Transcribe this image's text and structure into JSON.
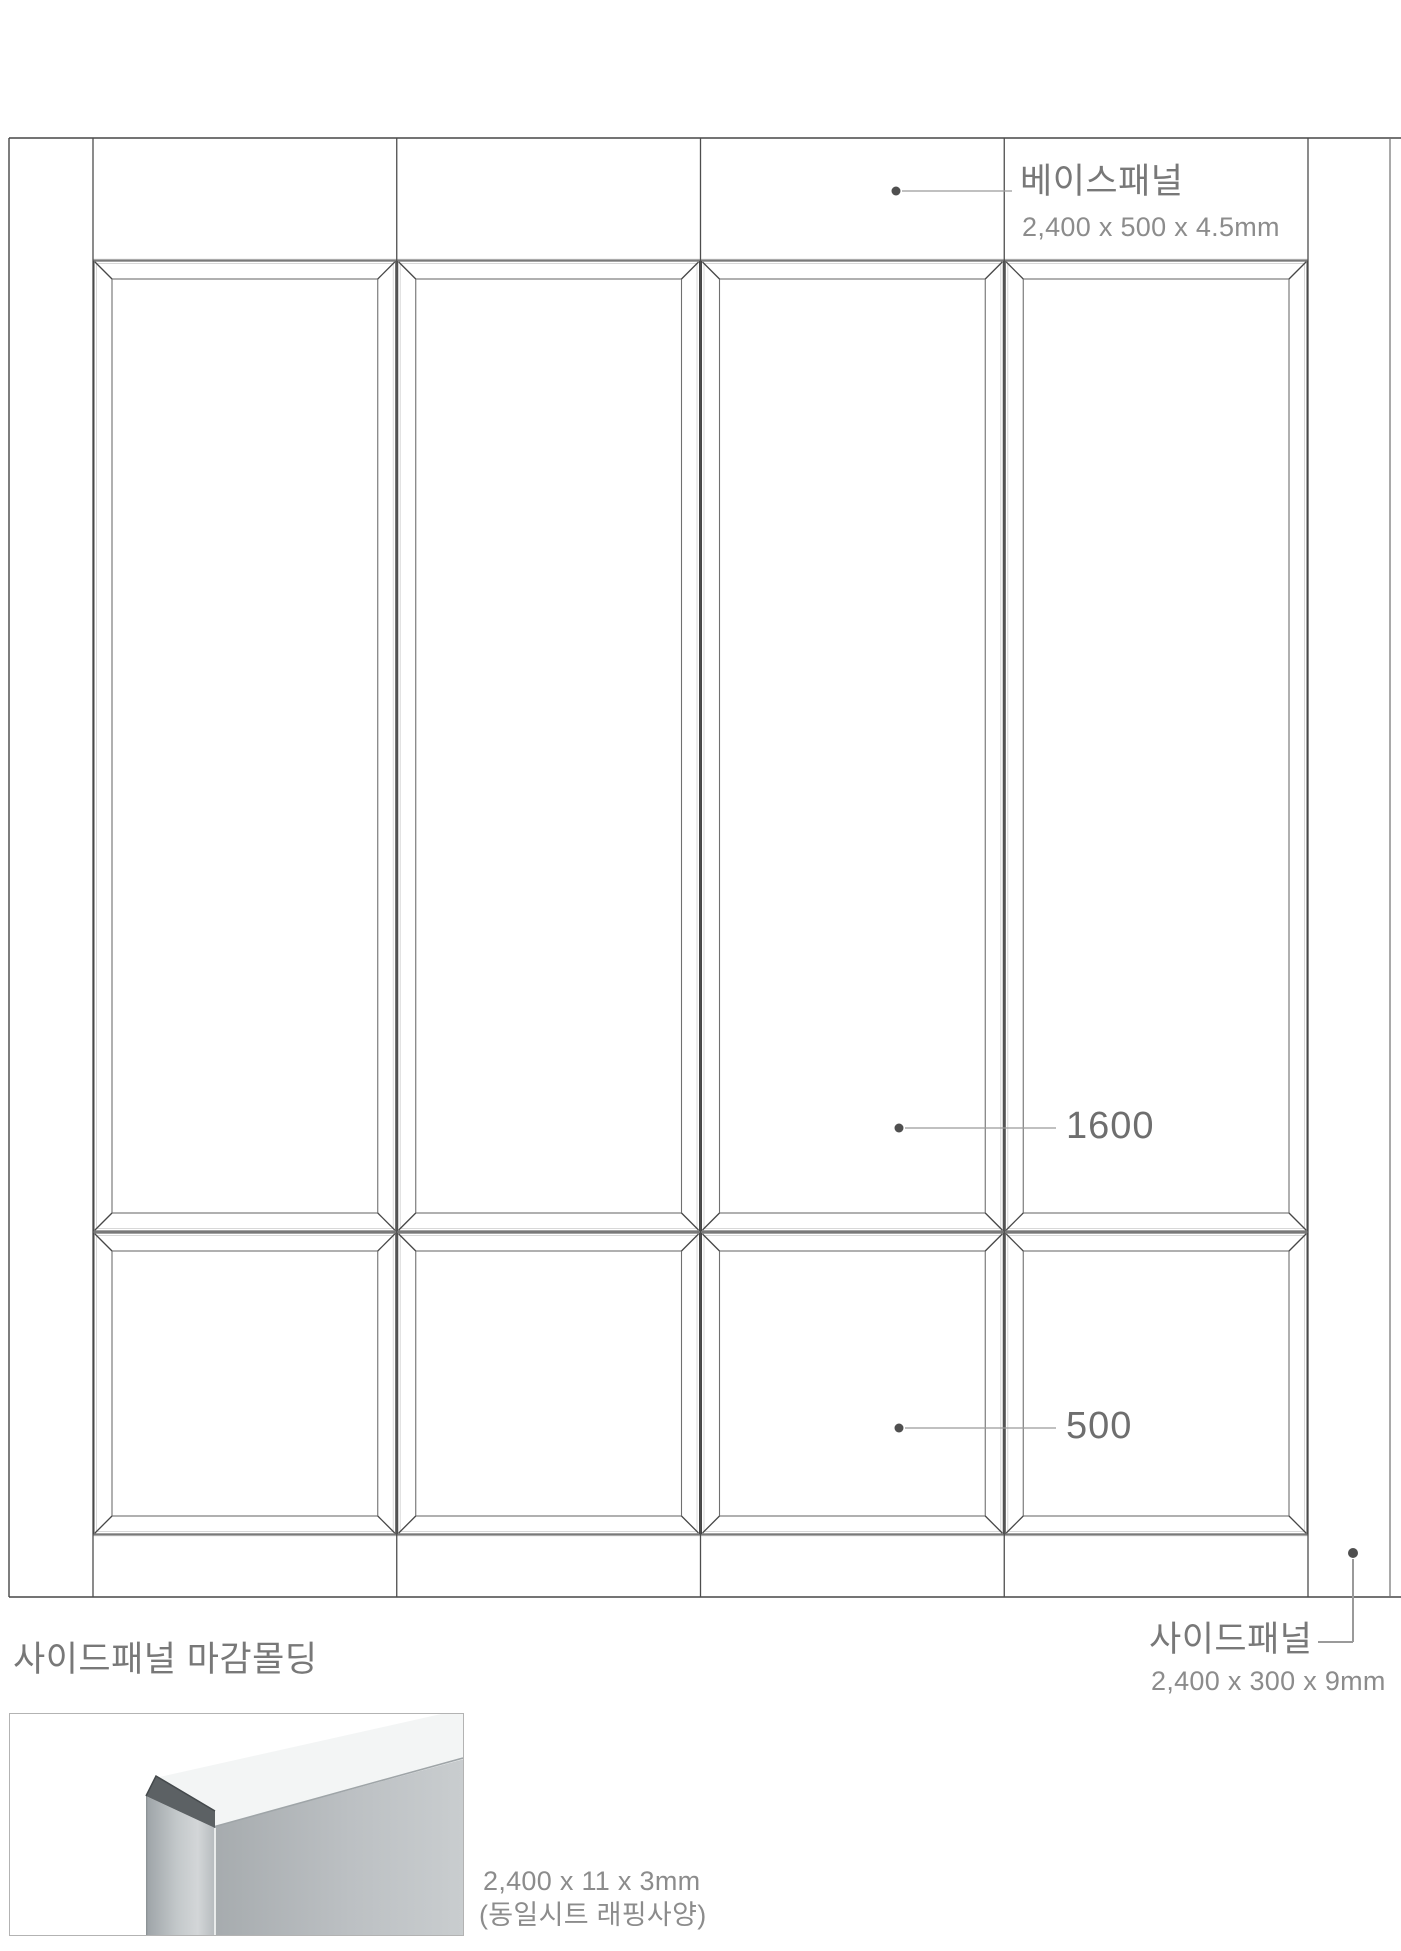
{
  "labels": {
    "base_panel": {
      "title": "베이스패널",
      "dim": "2,400 x 500 x 4.5mm"
    },
    "tall_height": "1600",
    "square_height": "500",
    "side_panel": {
      "title": "사이드패널",
      "dim": "2,400 x 300 x 9mm"
    },
    "molding": {
      "title": "사이드패널 마감몰딩",
      "dim": "2,400 x 11 x 3mm",
      "spec": "(동일시트 래핑사양)"
    }
  },
  "elevation": {
    "columns": 4,
    "rows": 2,
    "frame": {
      "left": 9,
      "top": 138,
      "right": 1390,
      "bottom": 1597,
      "page_right": 1401
    },
    "panel_area": {
      "x_start": 93,
      "x_end": 1308
    },
    "band_y": {
      "top_band_bottom": 260,
      "tall_square_junction": 1232,
      "square_bottom": 1535
    },
    "bevel_inset": 19,
    "sheet_inset": 3.5
  },
  "leaders": {
    "base_panel": {
      "dot": [
        896,
        191
      ],
      "line_end_x": 1012
    },
    "tall_height": {
      "dot": [
        899,
        1128
      ],
      "line_end_x": 1056
    },
    "square_height": {
      "dot": [
        899,
        1428
      ],
      "line_end_x": 1056
    },
    "side_panel": {
      "dot": [
        1353,
        1553
      ],
      "elbow": [
        1353,
        1642
      ],
      "line_end_x": 1318
    }
  },
  "colors": {
    "line_dark": "#474747",
    "line_mid": "#707070",
    "line_light": "#d8d8d8",
    "band_line": "#ababab",
    "leader_line": "#9a9a9a",
    "dot": "#4f4f4f",
    "photo_face_dark": "#a6abae",
    "photo_face_light": "#c9cdcf",
    "photo_top_face": "#f3f5f5",
    "photo_cap": "#5c6164",
    "photo_strip_dark": "#9da3a7",
    "photo_strip_light": "#d3d6d8"
  }
}
